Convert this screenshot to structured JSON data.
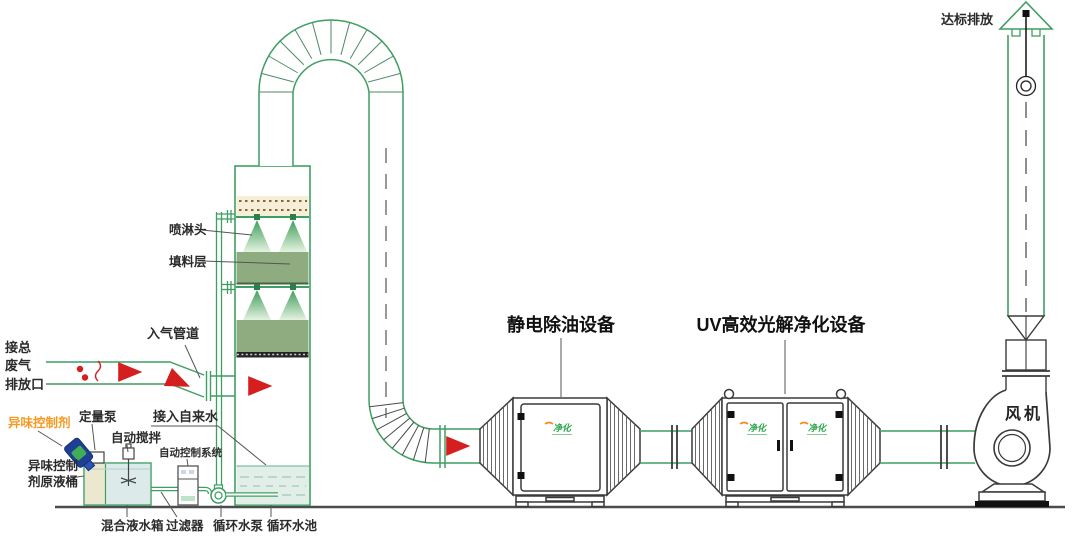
{
  "diagram": {
    "labels": {
      "emission": "达标排放",
      "fan": "风机",
      "esp_unit": "静电除油设备",
      "uv_unit": "UV高效光解净化设备",
      "spray_head": "喷淋头",
      "packing_layer": "填料层",
      "gas_inlet_pipe": "入气管道",
      "waste_inlet_l1": "接总",
      "waste_inlet_l2": "废气",
      "waste_inlet_l3": "排放口",
      "odor_agent": "异味控制剂",
      "metering_pump": "定量泵",
      "auto_stir": "自动搅拌",
      "auto_control": "自动控制系统",
      "odor_tank_l1": "异味控制",
      "odor_tank_l2": "剂原液桶",
      "tap_water": "接入自来水",
      "mixing_tank": "混合液水箱",
      "filter": "过滤器",
      "circ_pump": "循环水泵",
      "circ_pool": "循环水池",
      "door_logo": "净化"
    },
    "colors": {
      "pipe_green": "#3f9e63",
      "outline_dark": "#3a3a3a",
      "arrow_red": "#d51f1f",
      "odor_agent_orange": "#f59a23",
      "packing_green": "#8fac80",
      "water_fill": "#e2efe9",
      "demister_cream": "#f6eed6",
      "jug_blue": "#1e3f93",
      "logo_green": "#2fa84f",
      "logo_orange": "#f08a1d"
    }
  }
}
